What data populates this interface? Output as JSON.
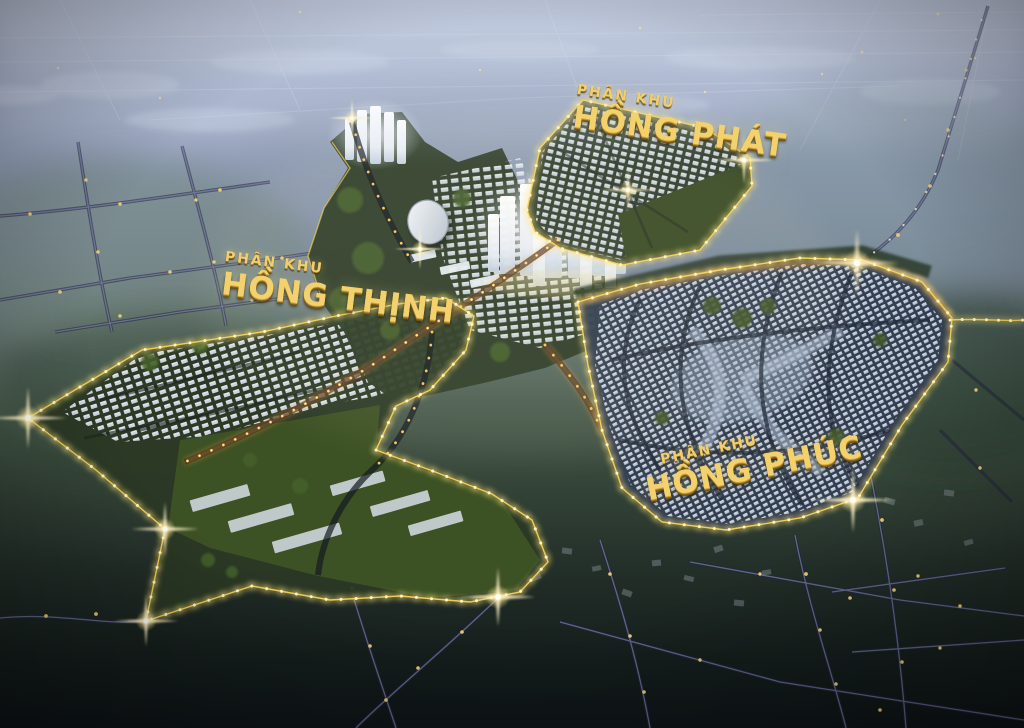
{
  "zones": [
    {
      "id": "hong-phat",
      "subtitle": "PHÂN KHU",
      "name": "HỒNG PHÁT"
    },
    {
      "id": "hong-thinh",
      "subtitle": "PHÂN KHU",
      "name": "HỒNG THỊNH"
    },
    {
      "id": "hong-phuc",
      "subtitle": "PHÂN KHU",
      "name": "HỒNG PHÚC"
    }
  ],
  "palette": {
    "sky_haze": "#a9b4cc",
    "mid_land": "#5f7060",
    "dark_ground": "#11171a",
    "boundary_glow": "#f8d24f",
    "street_light": "#ffc35c",
    "road_indigo": "#8287bd",
    "gold_text": "#f3d26e",
    "tower_glow": "#f6f9ff",
    "lawn_green": "#3f5426"
  }
}
